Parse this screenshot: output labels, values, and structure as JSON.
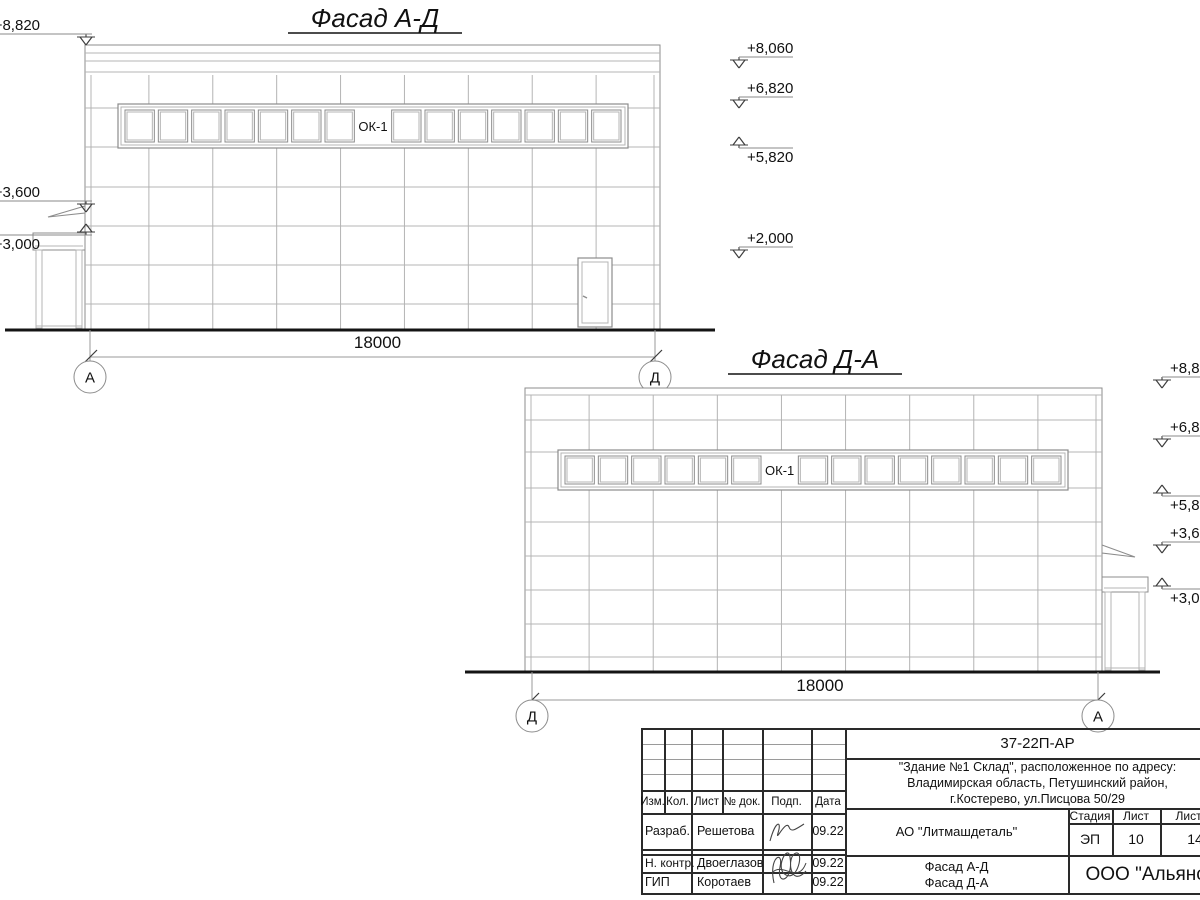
{
  "colors": {
    "line_light": "#b4b4b4",
    "line_med": "#8c8c8c",
    "line_dark": "#3c3c3c",
    "ground": "#141414",
    "text": "#111111"
  },
  "facade1": {
    "title": "Фасад А-Д",
    "window_label": "ОК-1",
    "dimension_label": "18000",
    "axis_left": "А",
    "axis_right": "Д",
    "marks_left": [
      {
        "label": "+8,820",
        "dir": "down",
        "y": 45
      },
      {
        "label": "+3,600",
        "dir": "down",
        "y": 212
      },
      {
        "label": "+3,000",
        "dir": "up",
        "y": 224
      }
    ],
    "marks_right": [
      {
        "label": "+8,060",
        "dir": "down",
        "y": 68
      },
      {
        "label": "+6,820",
        "dir": "down",
        "y": 108
      },
      {
        "label": "+5,820",
        "dir": "up",
        "y": 137
      },
      {
        "label": "+2,000",
        "dir": "down",
        "y": 258
      }
    ]
  },
  "facade2": {
    "title": "Фасад Д-А",
    "window_label": "ОК-1",
    "dimension_label": "18000",
    "axis_left": "Д",
    "axis_right": "А",
    "marks_right": [
      {
        "label": "+8,820",
        "dir": "down",
        "y": 388
      },
      {
        "label": "+6,820",
        "dir": "down",
        "y": 447
      },
      {
        "label": "+5,820",
        "dir": "up",
        "y": 485
      },
      {
        "label": "+3,600",
        "dir": "down",
        "y": 553
      },
      {
        "label": "+3,000",
        "dir": "up",
        "y": 578
      }
    ]
  },
  "titleblock": {
    "doc_number": "37-22П-АР",
    "object_lines": [
      "\"Здание №1 Склад\", расположенное по адресу:",
      "Владимирская область, Петушинский район,",
      "г.Костерево, ул.Писцова 50/29"
    ],
    "client": "АО \"Литмашдеталь\"",
    "sheet_title_lines": [
      "Фасад А-Д",
      "Фасад Д-А"
    ],
    "organization": "ООО \"Альянс\"",
    "stage_label": "Стадия",
    "sheet_label": "Лист",
    "sheets_label": "Листов",
    "stage_value": "ЭП",
    "sheet_value": "10",
    "sheets_value": "14",
    "header_cols": [
      "Изм.",
      "Кол.",
      "Лист",
      "№ док.",
      "Подп.",
      "Дата"
    ],
    "rows": [
      {
        "role": "Разраб.",
        "name": "Решетова",
        "date": "09.22"
      },
      {
        "role": "Н. контр.",
        "name": "Двоеглазов",
        "date": "09.22"
      },
      {
        "role": "ГИП",
        "name": "Коротаев",
        "date": "09.22"
      }
    ]
  }
}
